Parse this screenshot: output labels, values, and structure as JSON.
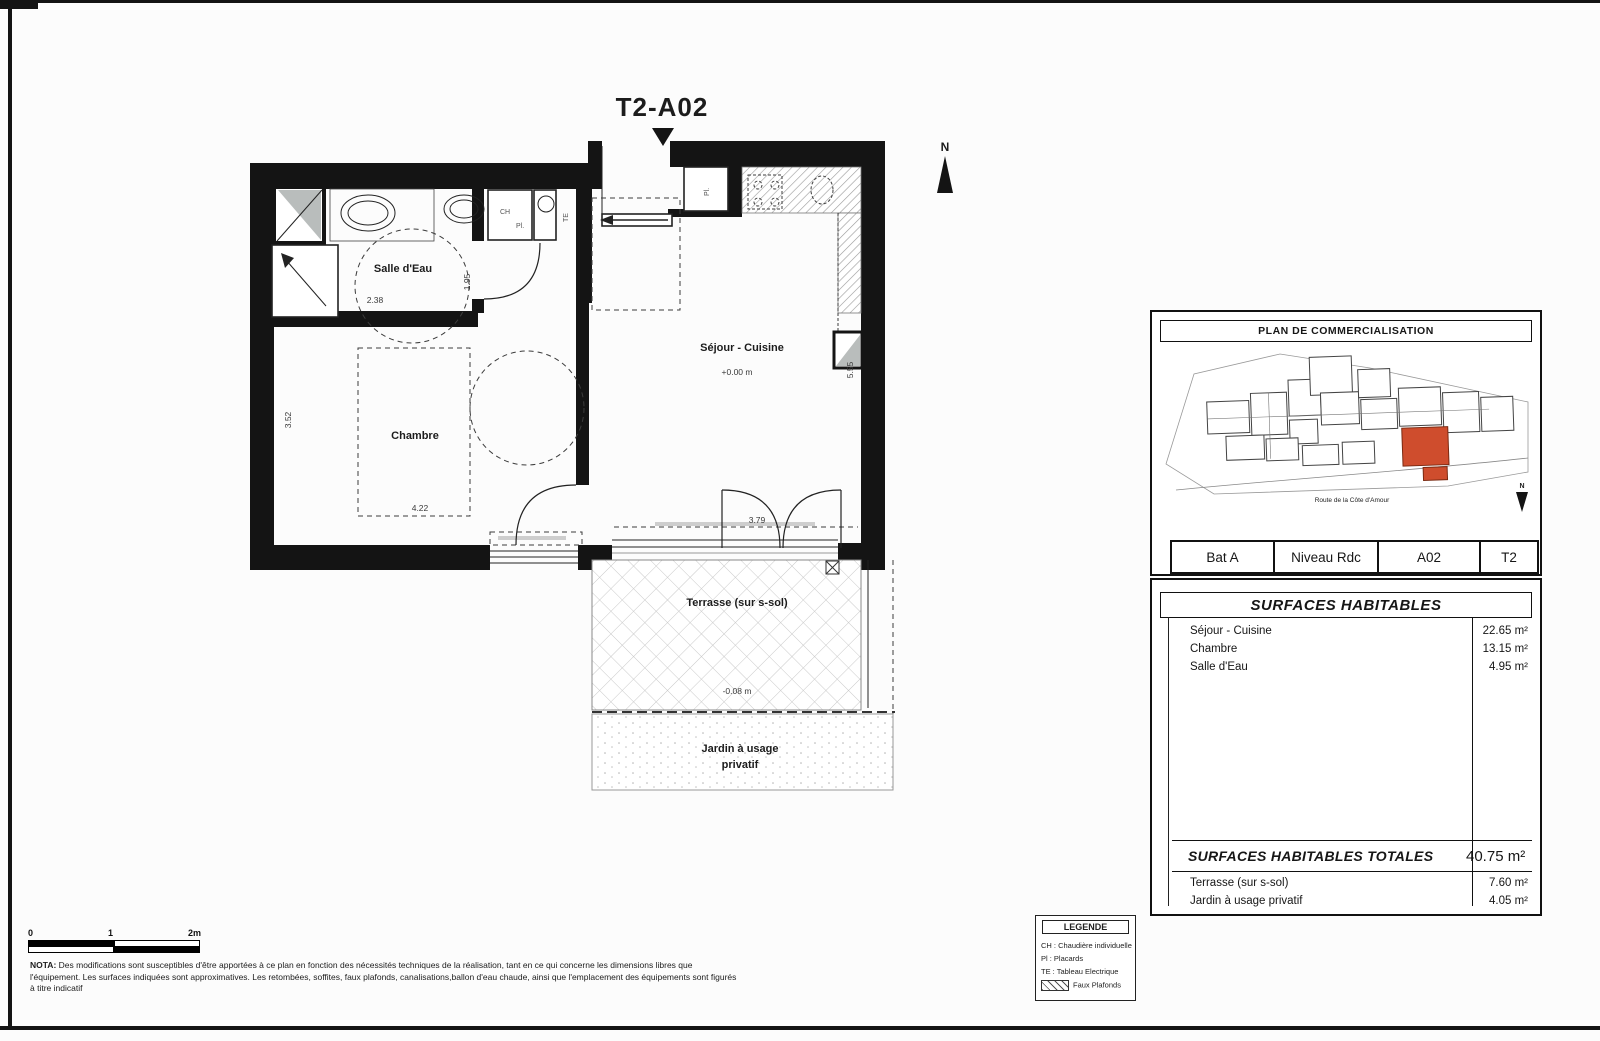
{
  "title": "T2-A02",
  "north": "N",
  "plan": {
    "rooms": {
      "salle_deau": "Salle d'Eau",
      "chambre": "Chambre",
      "sejour": "Séjour - Cuisine",
      "terrasse": "Terrasse (sur s-sol)",
      "jardin_1": "Jardin à usage",
      "jardin_2": "privatif"
    },
    "levels": {
      "sejour": "+0.00 m",
      "terrasse": "-0.08 m"
    },
    "dims": {
      "sde_w": "2.38",
      "sde_h": "1.95",
      "ch_w": "4.22",
      "ch_h": "3.52",
      "sej_w": "3.79",
      "sej_h": "5.55"
    },
    "tags": {
      "ch": "CH",
      "pl_entry": "Pl.",
      "te": "TE",
      "pl_kitchen": "Pl."
    }
  },
  "panel": {
    "plan_title": "PLAN DE COMMERCIALISATION",
    "road": "Route de la Côte d'Amour",
    "north": "N",
    "unit_cells": [
      "Bat A",
      "Niveau Rdc",
      "A02",
      "T2"
    ],
    "surfaces_title": "SURFACES HABITABLES",
    "surface_rows": [
      {
        "label": "Séjour - Cuisine",
        "value": "22.65 m²"
      },
      {
        "label": "Chambre",
        "value": "13.15 m²"
      },
      {
        "label": "Salle d'Eau",
        "value": "4.95 m²"
      }
    ],
    "totals_label": "SURFACES HABITABLES TOTALES",
    "totals_value": "40.75 m²",
    "annex_rows": [
      {
        "label": "Terrasse (sur s-sol)",
        "value": "7.60 m²"
      },
      {
        "label": "Jardin à usage privatif",
        "value": "4.05 m²"
      }
    ]
  },
  "legend": {
    "title": "LEGENDE",
    "items": [
      "CH : Chaudière individuelle",
      "Pl : Placards",
      "TE : Tableau Electrique"
    ],
    "hatch": "Faux Plafonds"
  },
  "scale": {
    "zero": "0",
    "one": "1",
    "two": "2m"
  },
  "nota": {
    "label": "NOTA:",
    "text": " Des modifications sont susceptibles d'être apportées à ce plan en fonction des nécessités techniques de la réalisation, tant en ce qui concerne les dimensions libres que l'équipement. Les surfaces indiquées sont approximatives. Les retombées, soffites, faux plafonds, canalisations,ballon d'eau chaude, ainsi que l'emplacement des équipements sont figurés à titre indicatif"
  },
  "colors": {
    "wall": "#141414",
    "highlight": "#cf4d2d"
  }
}
